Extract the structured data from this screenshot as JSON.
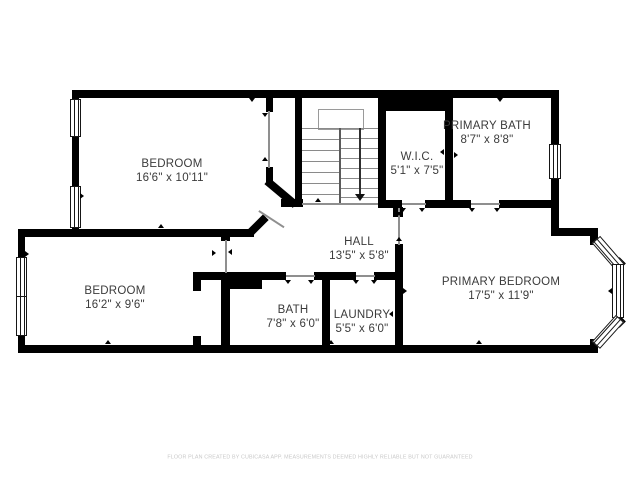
{
  "floorplan": {
    "rooms": [
      {
        "name": "BEDROOM",
        "dims": "16'6\" x 10'11\""
      },
      {
        "name": "PRIMARY BATH",
        "dims": "8'7\" x 8'8\""
      },
      {
        "name": "W.I.C.",
        "dims": "5'1\" x 7'5\""
      },
      {
        "name": "HALL",
        "dims": "13'5\" x 5'8\""
      },
      {
        "name": "BEDROOM",
        "dims": "16'2\" x 9'6\""
      },
      {
        "name": "BATH",
        "dims": "7'8\" x 6'0\""
      },
      {
        "name": "LAUNDRY",
        "dims": "5'5\" x 6'0\""
      },
      {
        "name": "PRIMARY BEDROOM",
        "dims": "17'5\" x 11'9\""
      }
    ],
    "stairs": {
      "direction_icon": "stairs-down-arrow-icon"
    },
    "footer": "FLOOR PLAN CREATED BY CUBICASA APP. MEASUREMENTS DEEMED HIGHLY RELIABLE BUT NOT GUARANTEED",
    "colors": {
      "wall": "#000000",
      "background": "#ffffff",
      "label": "#3b3b3b",
      "footer": "#c9c9c9"
    }
  }
}
